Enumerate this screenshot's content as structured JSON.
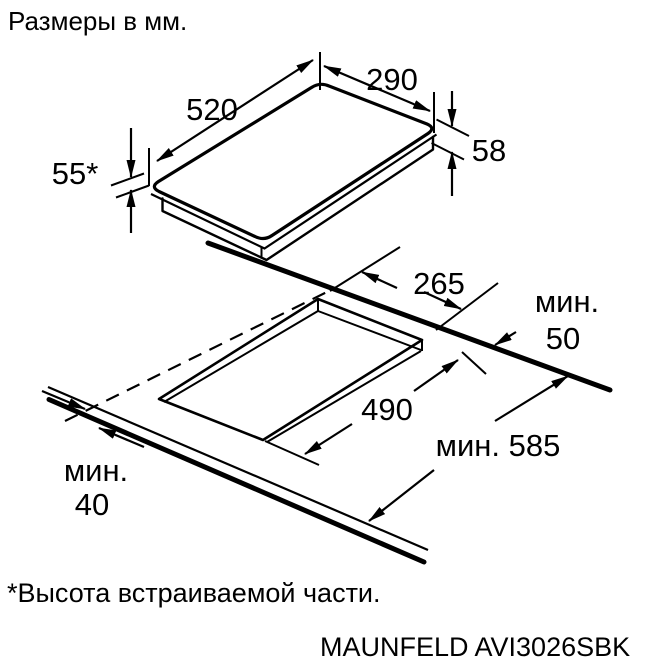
{
  "title": "Размеры в мм.",
  "footnote": "*Высота встраиваемой части.",
  "model": "MAUNFELD AVI3026SBK",
  "colors": {
    "ink": "#000000",
    "background": "#ffffff"
  },
  "top_view": {
    "description": "3D view of domino hob",
    "width": "520",
    "depth": "290",
    "overall_height": "58",
    "builtin_height": "55*"
  },
  "cutout_view": {
    "description": "worktop cutout view",
    "cutout_depth": "265",
    "cutout_width": "490",
    "min_rear_prefix": "мин.",
    "min_rear_value": "50",
    "min_worktop_depth": "мин. 585",
    "min_front_prefix": "мин.",
    "min_front_value": "40"
  }
}
